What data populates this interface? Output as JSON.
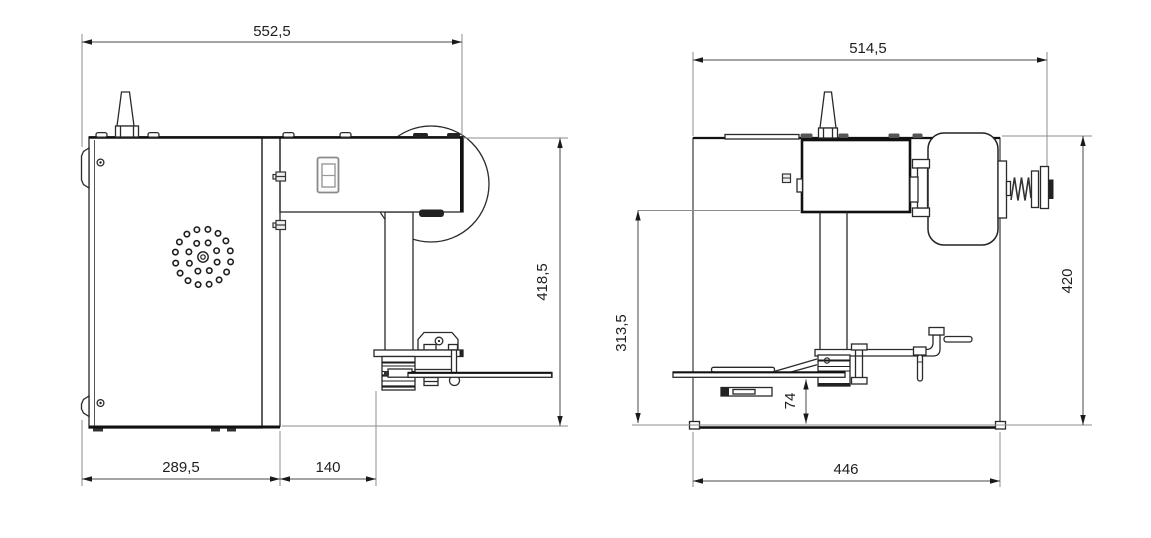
{
  "drawing": {
    "type": "technical-drawing",
    "background": "#ffffff",
    "line_color": "#1f1f1f",
    "dimension_color": "#4a4a4a",
    "views": {
      "side_view": {
        "dimensions": {
          "overall_width": "552,5",
          "overall_height": "418,5",
          "cabinet_depth": "289,5",
          "column_offset": "140"
        }
      },
      "front_view": {
        "dimensions": {
          "overall_width": "514,5",
          "overall_height": "420",
          "column_height": "313,5",
          "table_clearance": "74",
          "base_width": "446"
        }
      }
    }
  }
}
